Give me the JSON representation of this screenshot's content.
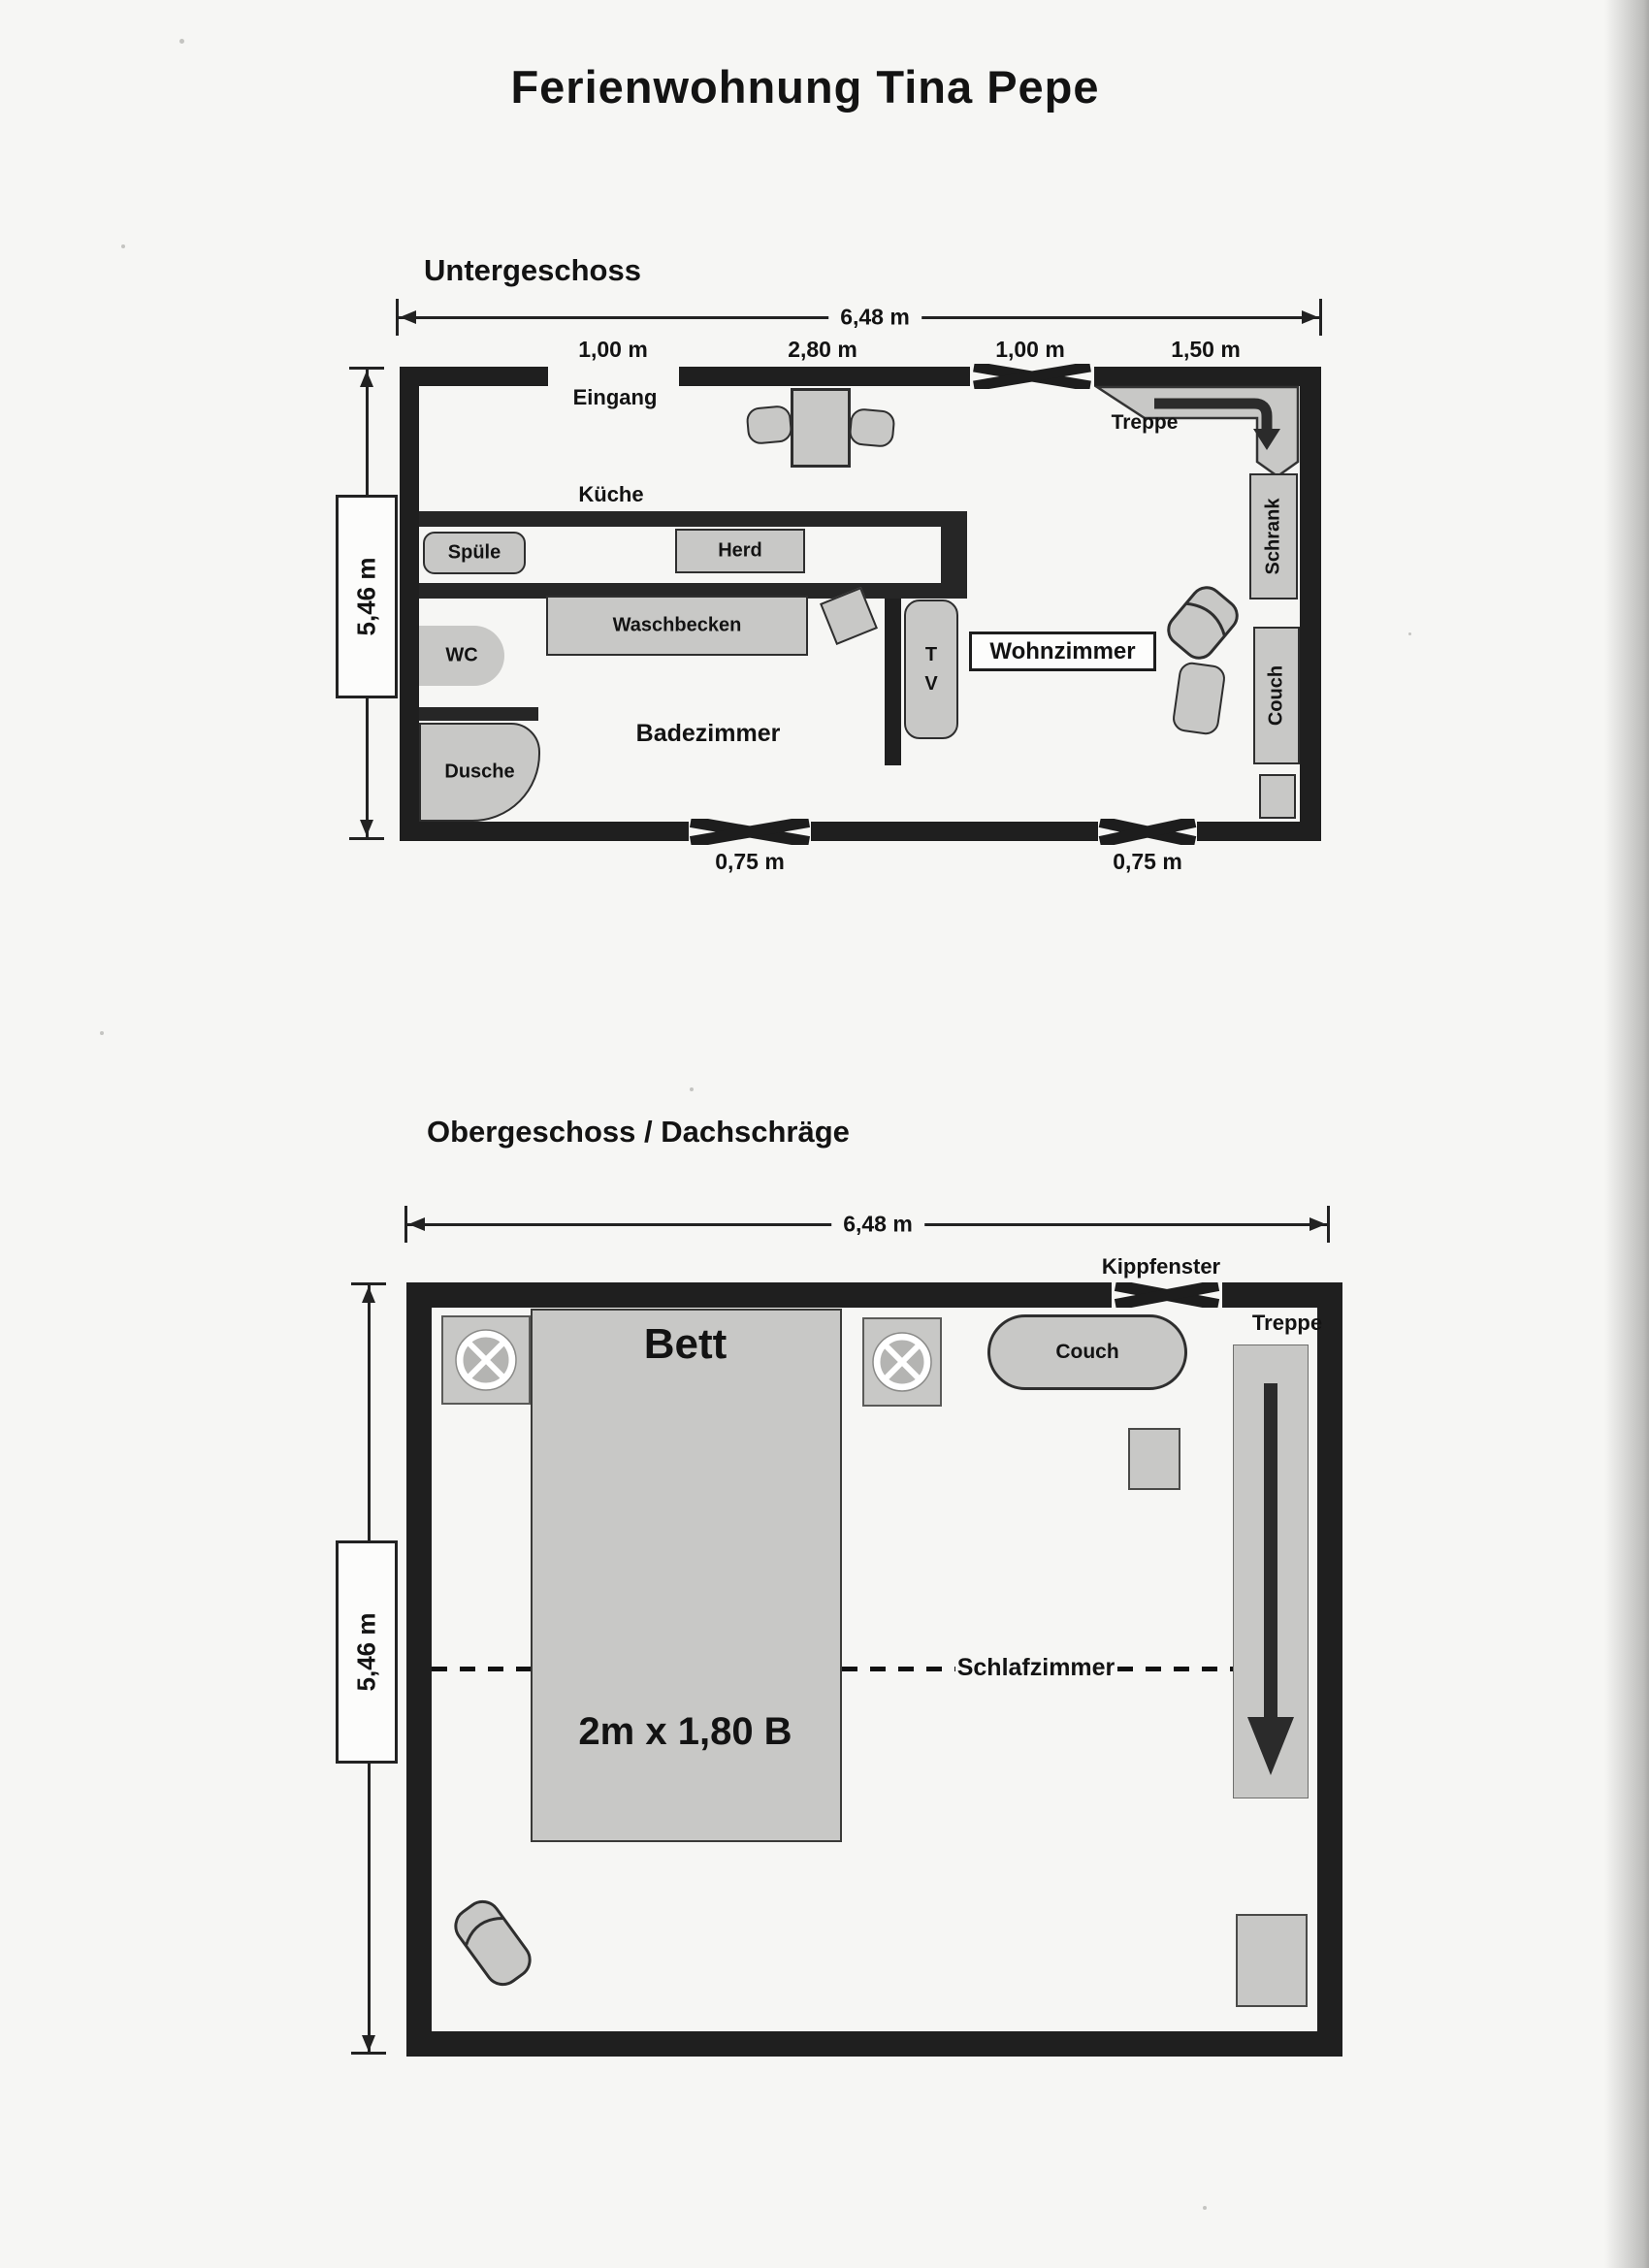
{
  "title": "Ferienwohnung Tina Pepe",
  "colors": {
    "wall": "#1f1f1f",
    "furniture_fill": "#c8c8c6",
    "furniture_border": "#2e2e2e",
    "paper": "#f6f6f4",
    "text": "#131313"
  },
  "ug": {
    "heading": "Untergeschoss",
    "dim_width": "6,48 m",
    "dim_height": "5,46 m",
    "seg1": "1,00 m",
    "seg2": "2,80 m",
    "seg3": "1,00 m",
    "seg4": "1,50 m",
    "win1": "0,75 m",
    "win2": "0,75 m",
    "eingang": "Eingang",
    "kueche": "Küche",
    "spuele": "Spüle",
    "herd": "Herd",
    "waschbecken": "Waschbecken",
    "wc": "WC",
    "dusche": "Dusche",
    "badezimmer": "Badezimmer",
    "tv_line1": "T",
    "tv_line2": "V",
    "wohnzimmer": "Wohnzimmer",
    "treppe": "Treppe",
    "schrank": "Schrank",
    "couch": "Couch"
  },
  "og": {
    "heading": "Obergeschoss / Dachschräge",
    "dim_width": "6,48 m",
    "dim_height": "5,46 m",
    "kippfenster": "Kippfenster",
    "treppe": "Treppe",
    "couch": "Couch",
    "bett": "Bett",
    "bett_size": "2m x 1,80 B",
    "schlafzimmer": "Schlafzimmer"
  }
}
